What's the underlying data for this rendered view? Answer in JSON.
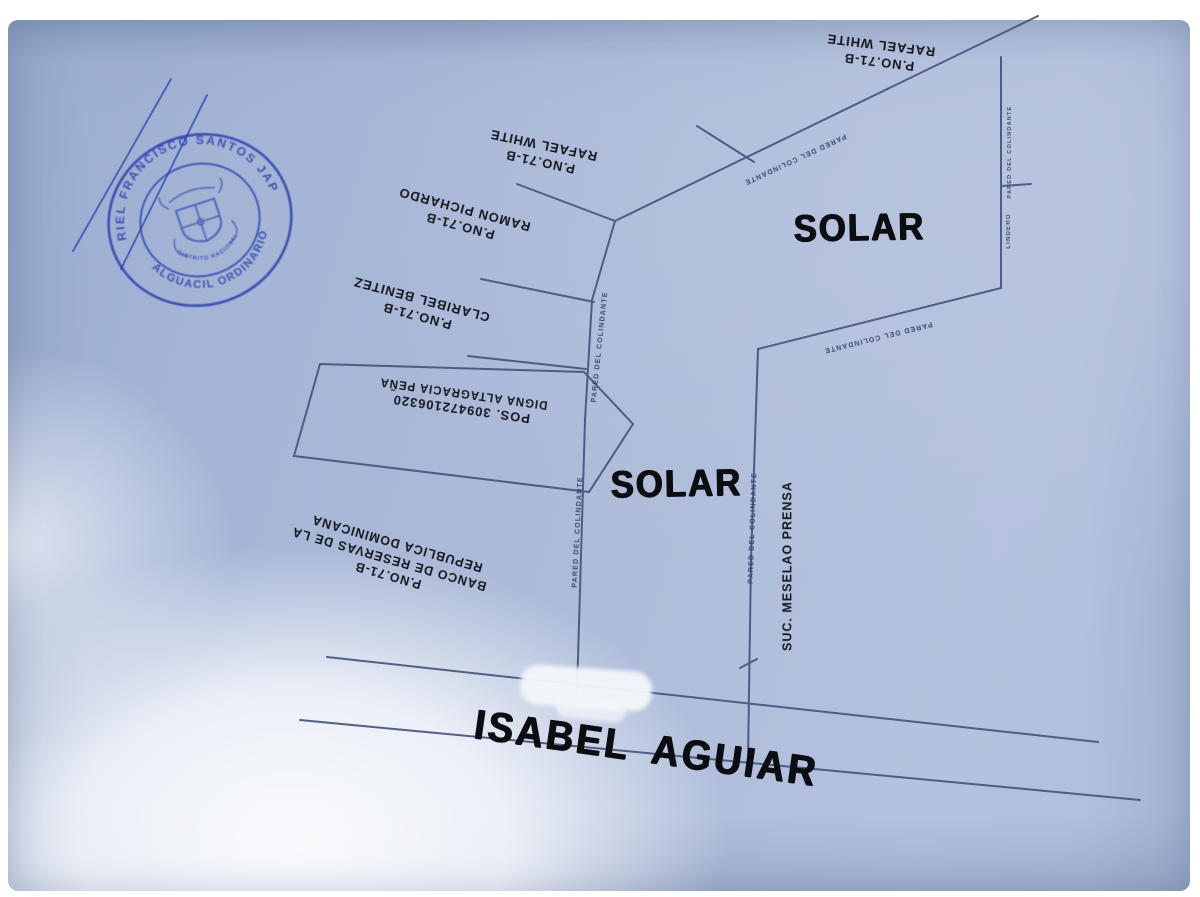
{
  "stamp": {
    "arc_top": "ARIEL FRANCISCO SANTOS JAPA",
    "arc_bottom": "ALGUACIL ORDINARIO",
    "inner_line": "DISTRITO NACIONAL"
  },
  "parcel_labels": {
    "rafael_white_top": {
      "line1": "P.NO.71-B",
      "line2": "RAFAEL WHITE"
    },
    "rafael_white_left": {
      "line1": "P.NO.71-B",
      "line2": "RAFAEL WHITE"
    },
    "ramon_pichardo": {
      "line1": "P.NO.71-B",
      "line2": "RAMON PICHARDO"
    },
    "claribel_benitez": {
      "line1": "P.NO.71-B",
      "line2": "CLARIBEL BENITEZ"
    },
    "digna_altagracia": {
      "line1": "POS. 309472106320",
      "line2": "DIGNA ALTAGRACIA PEÑA"
    },
    "banco_reservas": {
      "line1": "P.NO.71-B",
      "line2": "BANCO DE RESERVAS DE LA",
      "line3": "REPUBLICA DOMINICANA"
    },
    "suc_prensa": {
      "text": "SUC. MESELAO PRENSA"
    }
  },
  "area_labels": {
    "solar_top_right": "SOLAR",
    "solar_center": "SOLAR"
  },
  "street_label": "ISABEL AGUIAR",
  "boundary_annotations": {
    "diagonal_top": "PARED DEL COLINDANTE",
    "diagonal_right": "PARED DEL COLINDANTE",
    "central_upper": "PARED DEL COLINDANTE",
    "central_lower": "PARED DEL COLINDANTE",
    "right_lower": "PARED DEL COLINDANTE",
    "east_upper": "PARED DEL COLINDANTE",
    "east_lower": "LINDERO"
  },
  "colors": {
    "paper": "#aebddb",
    "survey_line": "#44547c",
    "lettering": "#15171d",
    "stamp_blue": "#2c3fae",
    "glare": "#f4f6fa"
  }
}
